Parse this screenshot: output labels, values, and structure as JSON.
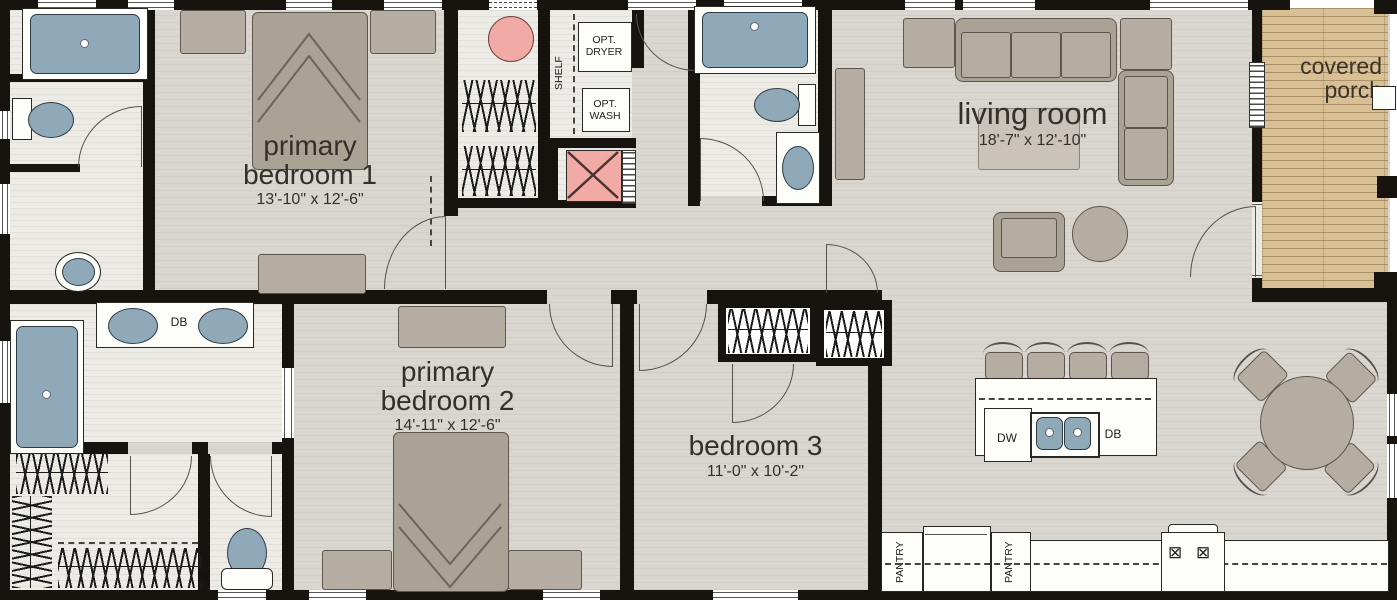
{
  "rooms": {
    "primary_bedroom_1": {
      "name": "primary bedroom 1",
      "dims": "13'-10\" x 12'-6\""
    },
    "primary_bedroom_2": {
      "name": "primary bedroom 2",
      "dims": "14'-11\" x 12'-6\""
    },
    "bedroom_3": {
      "name": "bedroom 3",
      "dims": "11'-0\" x 10'-2\""
    },
    "living_room": {
      "name": "living room",
      "dims": "18'-7\" x 12'-10\""
    },
    "covered_porch": {
      "name": "covered porch"
    }
  },
  "labels": {
    "shelf": "SHELF",
    "opt_dryer": "OPT. DRYER",
    "opt_wash": "OPT. WASH",
    "pantry_left": "PANTRY",
    "pantry_right": "PANTRY",
    "dw": "DW",
    "db_kitchen": "DB",
    "db_bath": "DB"
  },
  "icons": {
    "burner": "⊠"
  },
  "colors": {
    "wall": "#17140f",
    "floor": "#d9d6cf",
    "floor_light": "#edebe5",
    "porch_wood": "#d8c094",
    "fixture_blue": "#8fa9b8",
    "accent_pink": "#f2aaa7",
    "furniture": "#b6ada2"
  }
}
